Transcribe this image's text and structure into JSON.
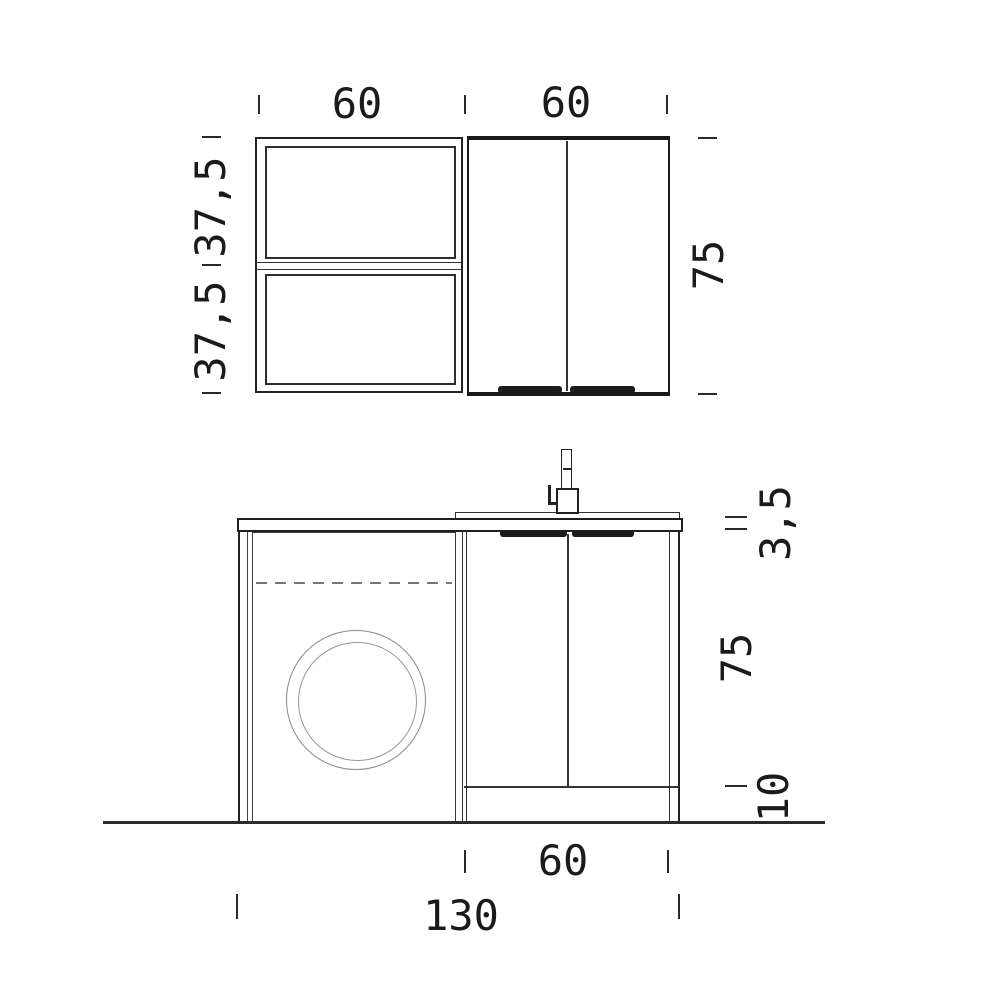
{
  "drawing": {
    "background_color": "#ffffff",
    "line_color": "#222222",
    "type": "furniture technical drawing with dimensions (cm)",
    "labels": {
      "top": {
        "shelf_unit_width": "60",
        "wall_cabinet_width": "60",
        "upper_shelf_height": "37,5",
        "lower_shelf_height": "37,5",
        "wall_cabinet_height": "75"
      },
      "front": {
        "countertop_thickness": "3,5",
        "base_cabinet_height": "75",
        "plinth_height": "10",
        "sink_unit_width": "60",
        "total_width": "130"
      }
    }
  }
}
